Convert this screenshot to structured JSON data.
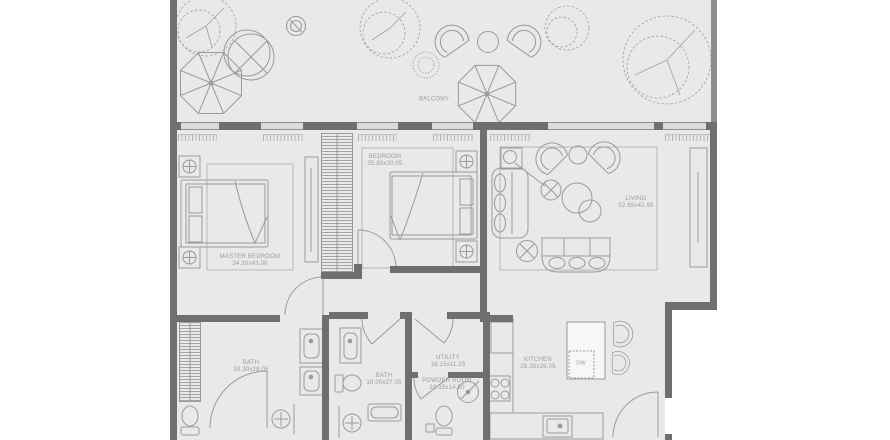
{
  "colors": {
    "background": "#ffffff",
    "floor": "#e9e9e9",
    "wall": "#6f6f6f",
    "furniture_line": "#9a9a9a",
    "text": "#9b9b9b"
  },
  "rooms": {
    "balcony": {
      "name": "BALCONY",
      "dims": ""
    },
    "master_bedroom": {
      "name": "MASTER BEDROOM",
      "dims": "34.30x43.00"
    },
    "bedroom": {
      "name": "BEDROOM",
      "dims": "35.80x30.05"
    },
    "living": {
      "name": "LIVING",
      "dims": "52.85x42.95"
    },
    "bath_1": {
      "name": "BATH",
      "dims": "30.30x28.05"
    },
    "bath_2": {
      "name": "BATH",
      "dims": "18.00x27.05"
    },
    "utility": {
      "name": "UTILITY",
      "dims": "16.15x11.25"
    },
    "powder_room": {
      "name": "POWDER ROOM",
      "dims": "16.15x14.80"
    },
    "kitchen": {
      "name": "KITCHEN",
      "dims": "28.35x28.05"
    }
  },
  "appliances": {
    "dishwasher": "DW"
  }
}
